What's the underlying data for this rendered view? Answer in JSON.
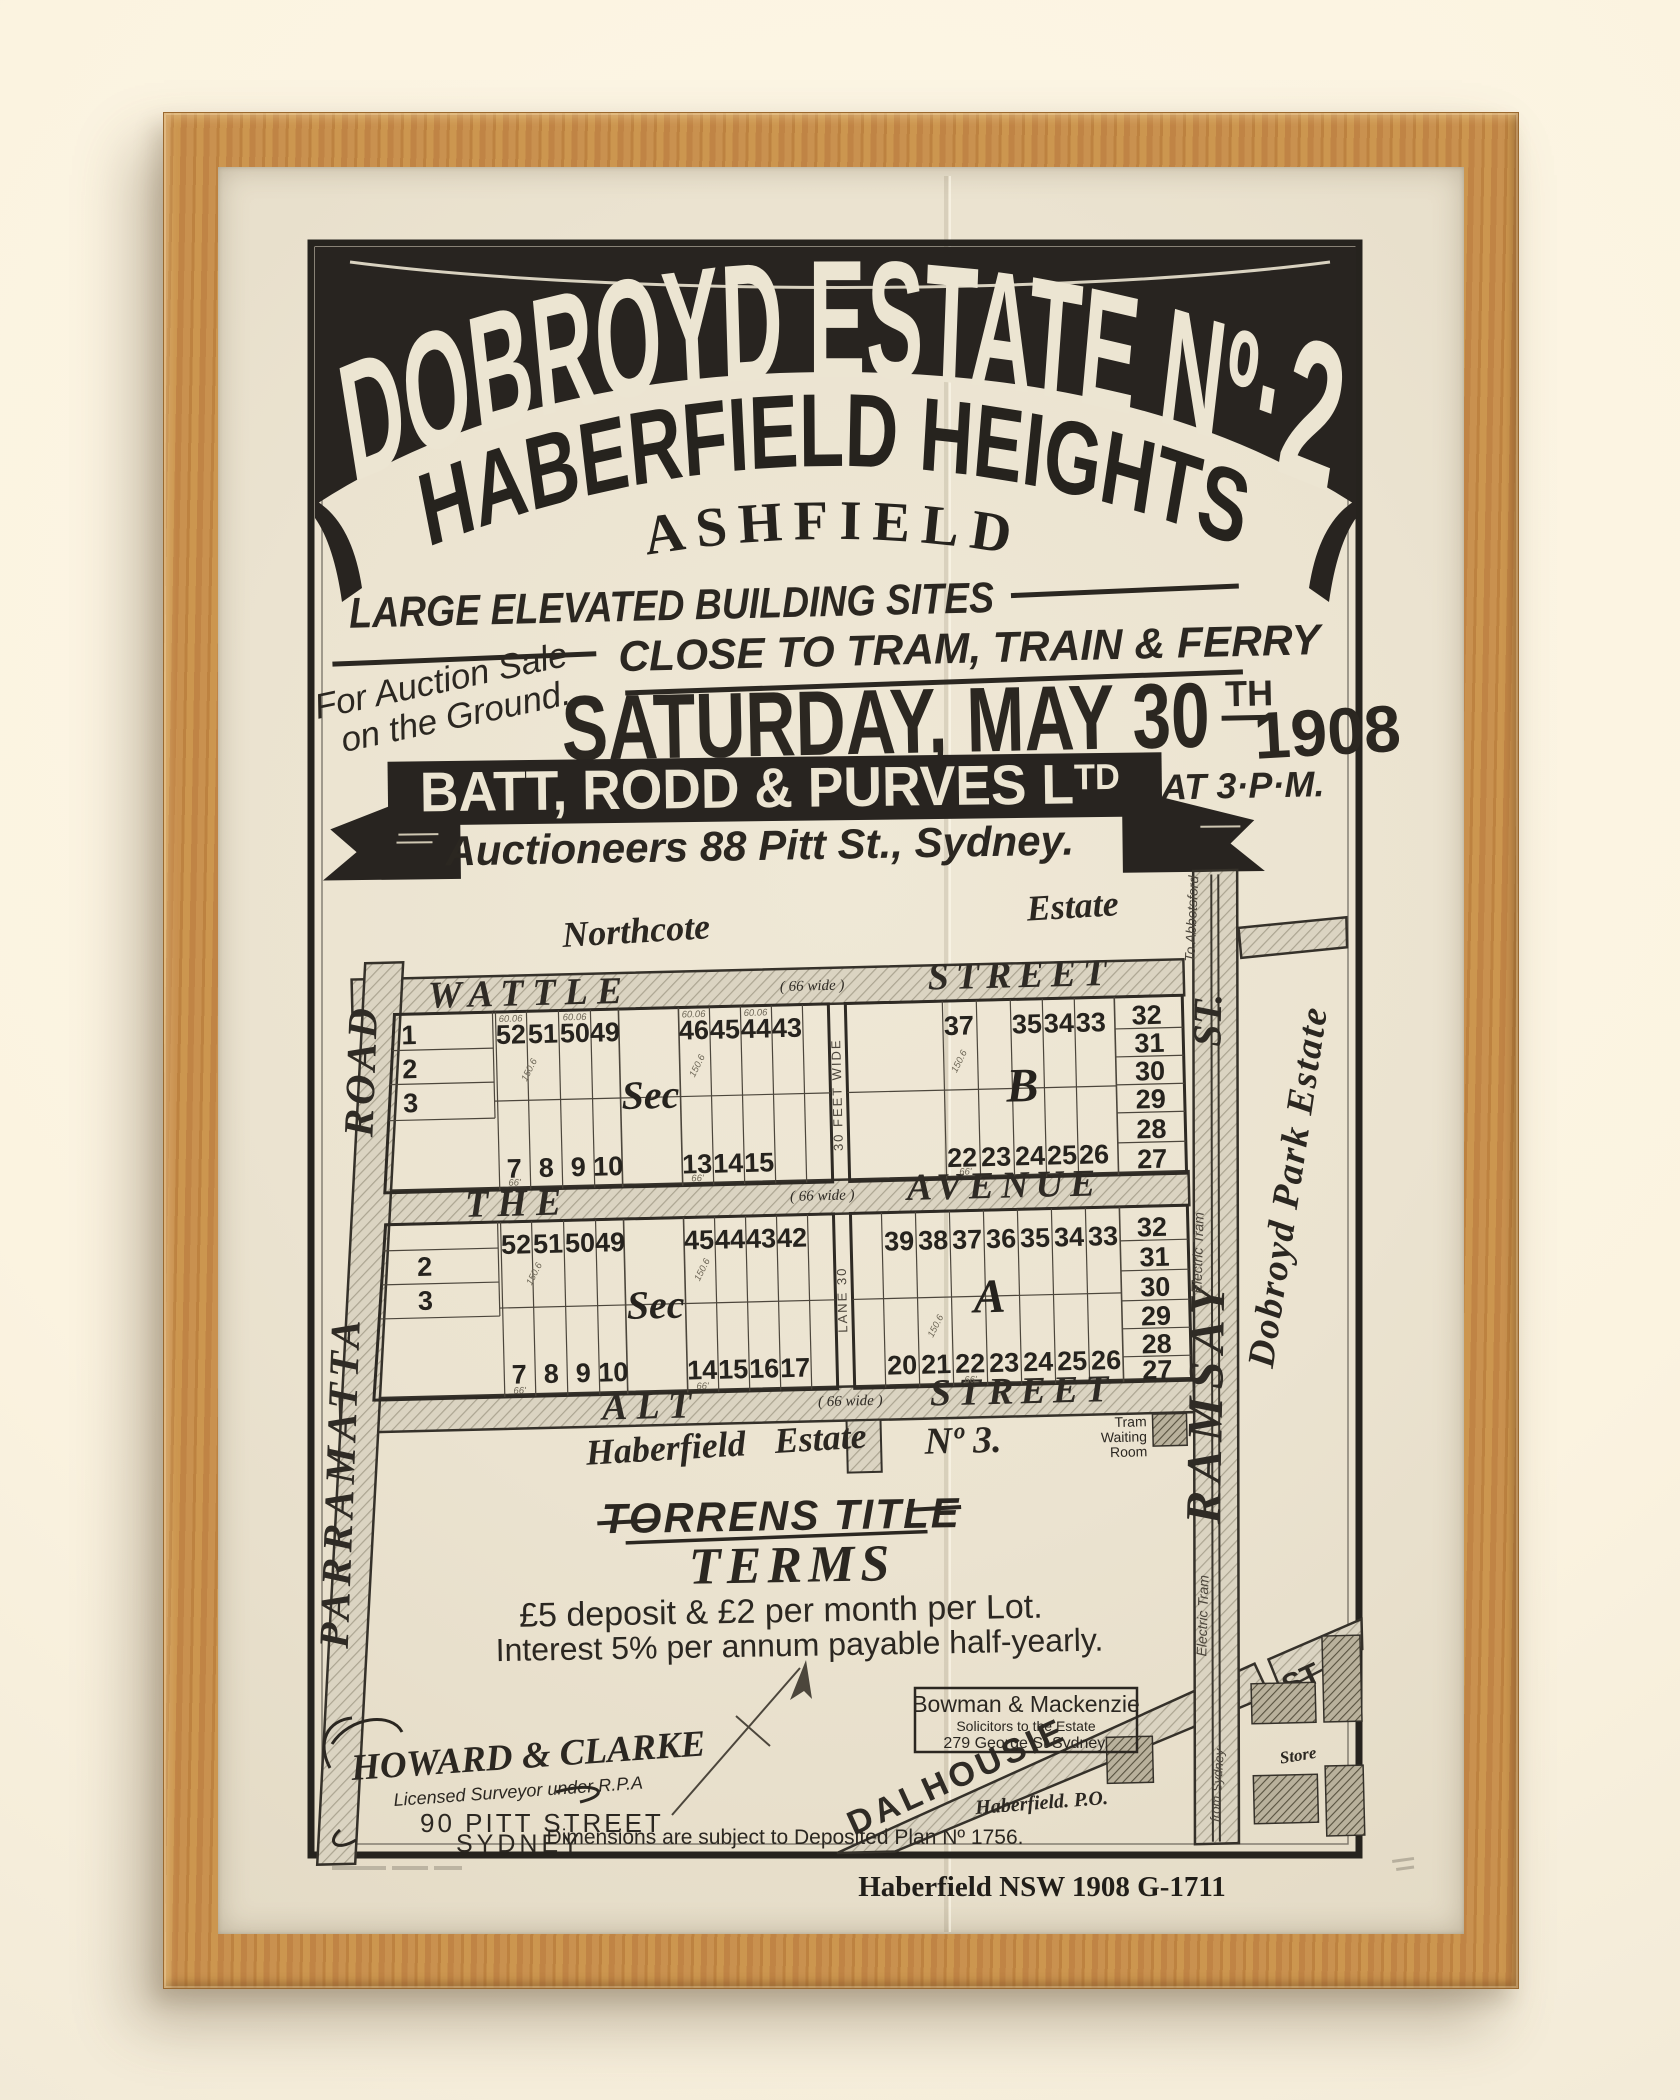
{
  "colors": {
    "ink": "#2b2721",
    "paper": "#ebe3d0",
    "banner": "#282420",
    "wood": "#c58d4d",
    "road": "#d9d2c0"
  },
  "header": {
    "title_main": "DOBROYD ESTATE Nº·",
    "title_num": "2",
    "subtitle": "HABERFIELD HEIGHTS",
    "locality": "ASHFIELD",
    "tagline1": "LARGE ELEVATED BUILDING SITES",
    "tagline2": "CLOSE TO TRAM, TRAIN & FERRY",
    "auction_note1": "For Auction Sale",
    "auction_note2": "on the Ground.",
    "date_main": "SATURDAY, MAY 30",
    "date_sup": "TH",
    "date_year": "1908",
    "time": "AT 3·P·M.",
    "agent_main": "BATT, RODD & PURVES L",
    "agent_sup": "TD",
    "agent_sub": "Auctioneers 88 Pitt St., Sydney."
  },
  "map": {
    "estate_north_1": "Northcote",
    "estate_north_2": "Estate",
    "estate_right": "Dobroyd Park Estate",
    "estate_south_1": "Haberfield",
    "estate_south_2": "Estate",
    "estate_south_3": "Nº 3.",
    "streets": {
      "wattle_l": "WATTLE",
      "wattle_note": "( 66  wide )",
      "wattle_r": "STREET",
      "avenue_l": "THE",
      "avenue_note": "( 66  wide )",
      "avenue_r": "AVENUE",
      "alt_l": "ALT",
      "alt_note": "( 66  wide )",
      "alt_r": "STREET",
      "parramatta_1": "ROAD",
      "parramatta_2": "PARRAMATTA",
      "ramsay_st": "ST.",
      "ramsay_name": "RAMSAY",
      "dalhousie": "DALHOUSIE",
      "dalhousie_st": "ST",
      "lane_top": "30 FEET WIDE",
      "lane_bottom": "LANE 30",
      "tram_upper": "Electric Tram",
      "tram_lower": "Electric Tram",
      "to_abbotsford": "To Abbotsford",
      "from_sydney": "from Sydney"
    },
    "poi": {
      "twr1": "Tram",
      "twr2": "Waiting",
      "twr3": "Room",
      "po": "Haberfield. P.O.",
      "store": "Store"
    },
    "sections": {
      "sec_label_b": "Sec",
      "sec_label_a": "Sec",
      "b": "B",
      "a": "A"
    },
    "lots": {
      "b_side": [
        "1",
        "2",
        "3"
      ],
      "b_top_a": [
        "52",
        "51",
        "50",
        "49"
      ],
      "b_top_b": [
        "46",
        "45",
        "44",
        "43"
      ],
      "b_bot_a": [
        "7",
        "8",
        "9",
        "10"
      ],
      "b_bot_b": [
        "13",
        "14",
        "15"
      ],
      "b_r_top": [
        "37",
        "35",
        "34",
        "33"
      ],
      "b_r_col": [
        "32",
        "31",
        "30",
        "29",
        "28",
        "27"
      ],
      "b_r_bot": [
        "22",
        "23",
        "24",
        "25",
        "26"
      ],
      "a_side": [
        "2",
        "3"
      ],
      "a_top_a": [
        "52",
        "51",
        "50",
        "49"
      ],
      "a_top_b": [
        "45",
        "44",
        "43",
        "42"
      ],
      "a_bot_a": [
        "7",
        "8",
        "9",
        "10"
      ],
      "a_bot_b": [
        "14",
        "15",
        "16",
        "17"
      ],
      "a_r_top": [
        "39",
        "38",
        "37",
        "36",
        "35",
        "34",
        "33"
      ],
      "a_r_col": [
        "32",
        "31",
        "30",
        "29",
        "28",
        "27"
      ],
      "a_r_bot": [
        "20",
        "21",
        "22",
        "23",
        "24",
        "25",
        "26"
      ]
    },
    "dims": {
      "frontage": "66'",
      "top": "60.06",
      "depth": "150.6"
    },
    "note_dimensions": "Dimensions are subject to Deposited Plan Nº 1756."
  },
  "footer": {
    "torrens": "TORRENS TITLE",
    "terms_title": "TERMS",
    "terms1": "£5 deposit & £2 per month per Lot.",
    "terms2": "Interest 5% per annum payable half-yearly.",
    "surveyor1": "HOWARD & CLARKE",
    "surveyor2": "Licensed Surveyor under R.P.A",
    "surveyor3": "90 PITT STREET",
    "surveyor4": "SYDNEY",
    "solicitor1": "Bowman & Mackenzie",
    "solicitor2": "Solicitors to the Estate",
    "solicitor3": "279 George St Sydney.",
    "caption": "Haberfield NSW 1908  G-1711"
  }
}
